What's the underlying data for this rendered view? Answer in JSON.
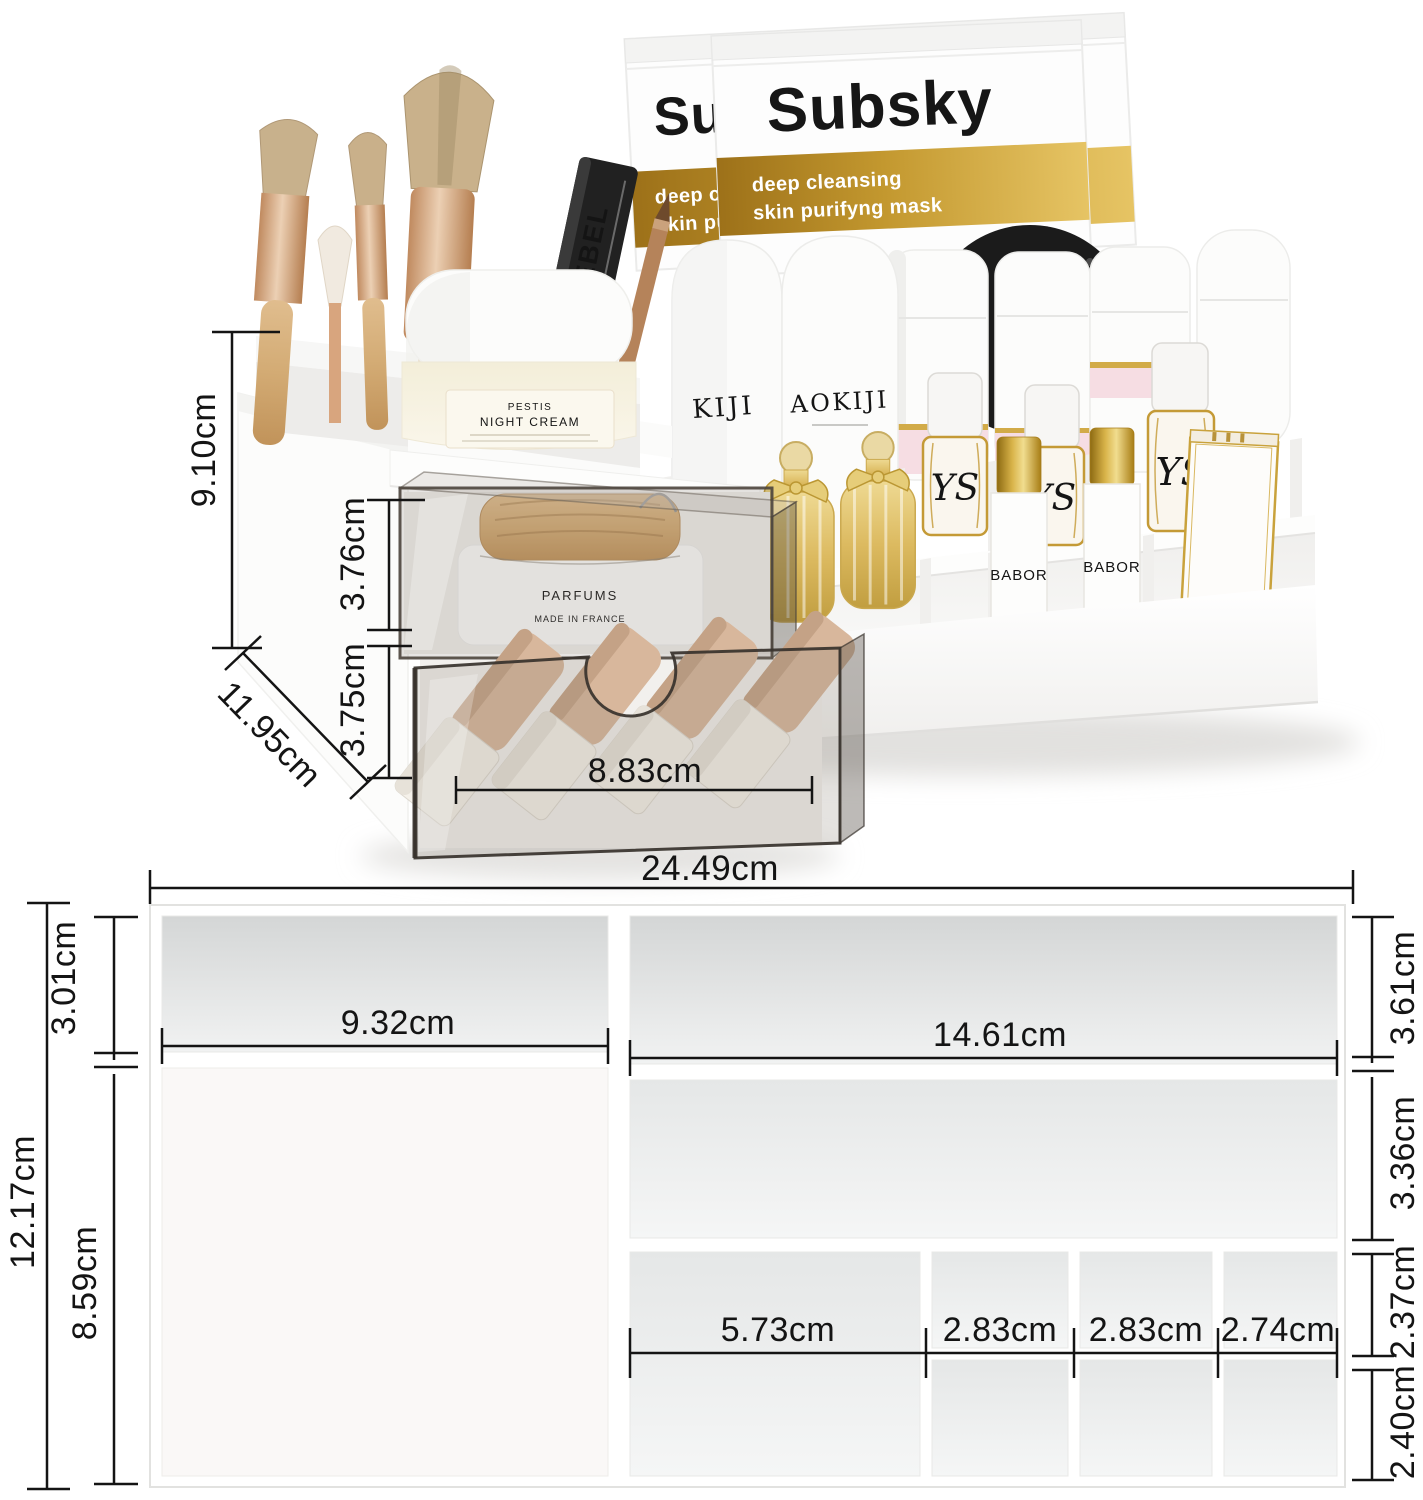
{
  "page": {
    "type": "cosmetic-organizer-dimension-image"
  },
  "brand": {
    "name": "Subsky",
    "tagline_line1": "deep cleansing",
    "tagline_line2": "skin purifyng mask"
  },
  "photo": {
    "dims": {
      "total_height": "9.10cm",
      "drawer1_height": "3.76cm",
      "drawer2_height": "3.75cm",
      "depth": "11.95cm",
      "drawer_inner_width": "8.83cm"
    },
    "items": {
      "mascara": "REBEL",
      "bottle_left_text": "KIJI",
      "bottle_right_text": "AOKIJI",
      "cream_jar_line1": "PESTIS",
      "cream_jar_line2": "NIGHT CREAM",
      "parfums_line1": "PARFUMS",
      "parfums_line2": "MADE IN FRANCE",
      "lotion_left": "BABOR",
      "lotion_right": "BABOR",
      "vial_monogram": "YS"
    }
  },
  "diagram": {
    "dims": {
      "overall_width": "24.49cm",
      "overall_height": "12.17cm",
      "top_left_height": "3.01cm",
      "bottom_left_height": "8.59cm",
      "top_left_width": "9.32cm",
      "top_right_width": "14.61cm",
      "top_right_height": "3.61cm",
      "middle_right_height": "3.36cm",
      "cell_row1_height": "2.37cm",
      "cell_row2_height": "2.40cm",
      "cell_col1_width": "5.73cm",
      "cell_col2_width": "2.83cm",
      "cell_col3_width": "2.83cm",
      "cell_col4_width": "2.74cm"
    }
  },
  "colors": {
    "gold_dark": "#9d7119",
    "gold_light": "#e6c464",
    "ink": "#141414"
  }
}
